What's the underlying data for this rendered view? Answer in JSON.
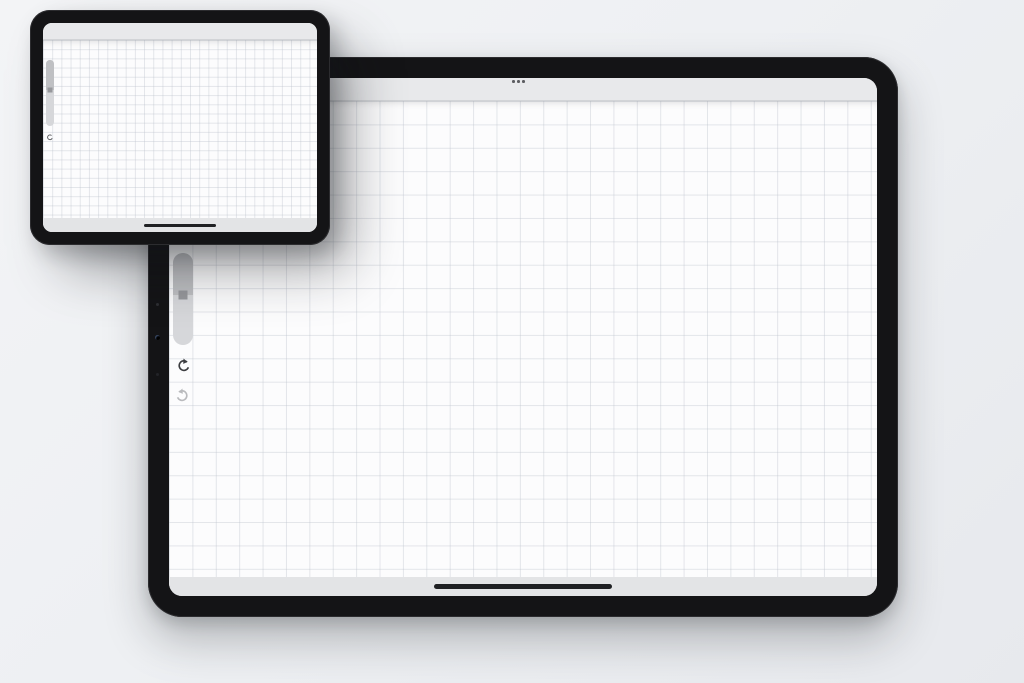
{
  "labels": {
    "before": "BEFORE",
    "after": "AFTER"
  },
  "after_tablet": {
    "toolbar": {
      "menu_icon": "ellipsis-menu",
      "tools": [
        {
          "name": "paint-brush",
          "active": true
        },
        {
          "name": "smudge-finger",
          "active": false
        },
        {
          "name": "eraser",
          "active": false
        },
        {
          "name": "layers",
          "active": false
        },
        {
          "name": "color-swatch",
          "active": false,
          "swatch_color": "#0b0b0c"
        }
      ]
    },
    "sidebar": {
      "items": [
        "brush-size-slider",
        "undo-button",
        "redo-button"
      ]
    },
    "home_indicator": true
  },
  "before_tablet": {
    "toolbar": {
      "gallery_label": "Gallery",
      "left_tools": [
        "actions-wrench",
        "adjustments-wand",
        "selection-s",
        "transform-arrow"
      ],
      "tools": [
        {
          "name": "paint-brush",
          "active": true
        },
        {
          "name": "smudge-finger",
          "active": false
        },
        {
          "name": "eraser",
          "active": false
        },
        {
          "name": "layers",
          "active": false
        },
        {
          "name": "color-swatch",
          "active": false,
          "swatch_color": "#0b0b0c"
        }
      ]
    },
    "home_indicator": true
  },
  "plan_labels": {
    "washer": "W",
    "chair_c": "C",
    "chair_d": "d"
  },
  "colors": {
    "accent": "#3a7bf2",
    "ink": "#151515",
    "icon": "#28282b",
    "canvas": "#fcfcfd",
    "toolbar": "#e8e9eb",
    "bezel": "#141416",
    "page_bg": "#eef0f3"
  }
}
